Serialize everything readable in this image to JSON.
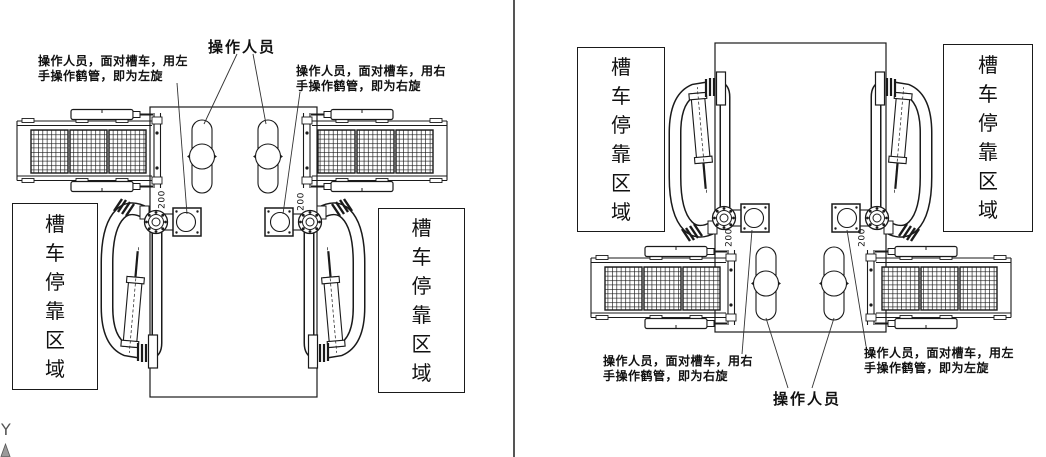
{
  "colors": {
    "line": "#1a1a1a",
    "divider": "#555555",
    "background": "#ffffff"
  },
  "left_drawing": {
    "operator_label": "操作人员",
    "note_left": {
      "line1": "操作人员，面对槽车，用左",
      "line2": "手操作鹤管，即为左旋"
    },
    "note_right": {
      "line1": "操作人员，面对槽车，用右",
      "line2": "手操作鹤管，即为右旋"
    },
    "parking_area_left": "槽车停靠区域",
    "parking_area_right": "槽车停靠区域",
    "dim_left": "200",
    "dim_right": "200"
  },
  "right_drawing": {
    "operator_label": "操作人员",
    "note_left": {
      "line1": "操作人员，面对槽车，用右",
      "line2": "手操作鹤管，即为右旋"
    },
    "note_right": {
      "line1": "操作人员，面对槽车，用左",
      "line2": "手操作鹤管，即为左旋"
    },
    "parking_area_left": "槽车停靠区域",
    "parking_area_right": "槽车停靠区域",
    "dim_left": "200",
    "dim_right": "200"
  },
  "axis_indicator": {
    "label": "Y"
  }
}
